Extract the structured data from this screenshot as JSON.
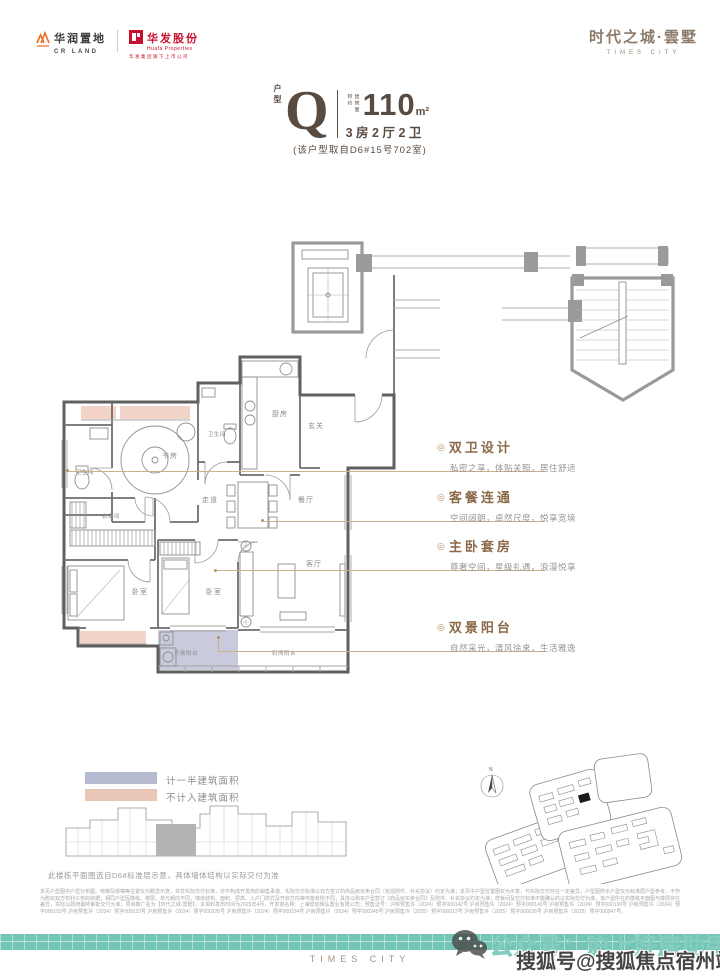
{
  "header": {
    "crland": {
      "icon": "mountain-logo",
      "name_cn": "华润置地",
      "name_en": "CR LAND"
    },
    "huafa": {
      "icon": "red-square-logo",
      "name_cn": "华发股份",
      "name_en": "Huafa Properties",
      "tagline": "华发集团旗下上市公司"
    },
    "project": {
      "name_cn": "时代之城·雲墅",
      "name_en": "TIMES CITY"
    }
  },
  "unit": {
    "type_label": "户型",
    "type_letter": "Q",
    "area_prefix": "建筑面积约",
    "area_value": "110",
    "area_unit": "m²",
    "layout": "3房2厅2卫",
    "source_note": "(该户型取自D6#15号702室)"
  },
  "floorplan": {
    "rooms": [
      {
        "label": "书房"
      },
      {
        "label": "卫生间"
      },
      {
        "label": "卫生间"
      },
      {
        "label": "厨房"
      },
      {
        "label": "玄关"
      },
      {
        "label": "走道"
      },
      {
        "label": "餐厅"
      },
      {
        "label": "衣帽间"
      },
      {
        "label": "卧室"
      },
      {
        "label": "卧室"
      },
      {
        "label": "客厅"
      },
      {
        "label": "开敞阳台"
      },
      {
        "label": "封闭阳台"
      }
    ]
  },
  "features": [
    {
      "bullet": "◎",
      "title": "双卫设计",
      "desc": "私密之享，体贴关照，居住舒适"
    },
    {
      "bullet": "◎",
      "title": "客餐连通",
      "desc": "空间阔朗，卓然尺度，悦享宽境"
    },
    {
      "bullet": "◎",
      "title": "主卧套房",
      "desc": "尊奢空间，星级礼遇，浪漫悦享"
    },
    {
      "bullet": "◎",
      "title": "双景阳台",
      "desc": "自然采光，清风徐来，生活雅逸"
    }
  ],
  "legend": {
    "items": [
      {
        "label": "计一半建筑面积",
        "color": "#b6bad0"
      },
      {
        "label": "不计入建筑面积",
        "color": "#eac6b6"
      }
    ],
    "building_note": "此楼栋平面图选自D6#标准层示意，具体墙体结构以实际交付为准"
  },
  "site": {
    "north_label": "N"
  },
  "disclaimer": {
    "text": "本页户型图中户型分布图、电梯及楼梯等位置仅为概念示意，并非实际交付标准，亦不构成开发商的销售承诺，实际交付标准以双方签订的商品房买卖合同（包括附件、补充协议）约定为准；本页中户型位置图仅为示意，与实际交付存在一定差异，户型图所示户型仅为标准层户型参考，不作为购买双方权利义务的依据；相同户型因楼栋、楼层、单元朝向不同，墙体结构、面积、层高、入户门样式及开启方向等可能有所不同，具体以购买户型签订《商品房买卖合同》及附件、补充协议约定为准；样板间及交付标准不能确认的以实际交付为准，该户型所在的楼栋平面图与楼层存在差异，实际以政府最终审批交付为准；项目推广名为【时代之城·雲墅】，本资料发布时间为2025年4月，开发商名称：上海璟琥辉弘置业有限公司；预售证号：沪房预售许（2024）预字000142号 沪房预售许（2024）预字000143号 沪房预售许（2024）预字000190号 沪房预售许（2024）预字000193号 沪房预售许（2024）预字000223号 沪房预售许（2024）预字000226号 沪房预售许（2024）预字000234号 沪房预售许（2024）预字000245号 沪房预售许（2025）预字000013号 沪房预售许（2025）预字000036号 沪房预售许（2025）预字000047号。"
  },
  "footer": {
    "brand_en": "TIMES CITY"
  },
  "watermarks": {
    "wechat": "公众号：沪上好房助手",
    "sohu": "搜狐号@搜狐焦点宿州站"
  },
  "colors": {
    "accent_brown": "#5a4b41",
    "accent_tan": "#b39060",
    "teal_band": "#72c6b3",
    "plan_pink": "#f2d4c8",
    "plan_lavender": "#c9cbdc",
    "legend_blue": "#b6bad0",
    "legend_pink": "#eac6b6",
    "cr_orange": "#e96b1c",
    "huafa_red": "#c8102e"
  }
}
